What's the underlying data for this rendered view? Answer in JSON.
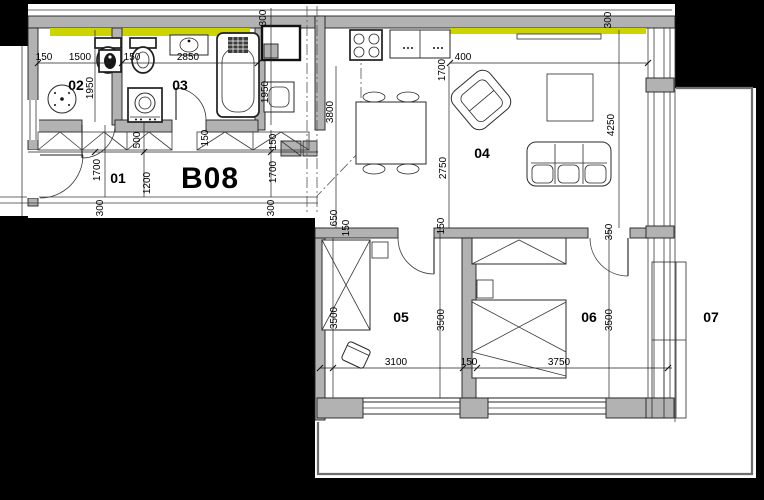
{
  "unit": {
    "code": "B08"
  },
  "rooms": {
    "r01": "01",
    "r02": "02",
    "r03": "03",
    "r04": "04",
    "r05": "05",
    "r06": "06",
    "r07": "07"
  },
  "dims": {
    "d150": "150",
    "d300": "300",
    "d350": "350",
    "d400": "400",
    "d500": "500",
    "d650": "650",
    "d1200": "1200",
    "d1500": "1500",
    "d1700": "1700",
    "d1950": "1950",
    "d2750": "2750",
    "d2850": "2850",
    "d3100": "3100",
    "d3500": "3500",
    "d3750": "3750",
    "d3800": "3800",
    "d4250": "4250"
  },
  "fixtures": [
    "toilet",
    "round-washbasin",
    "washbasin",
    "vanity-sink",
    "bathtub",
    "washing-machine",
    "stove",
    "kitchen-counter",
    "dining-table",
    "chair",
    "armchair",
    "sofa",
    "coffee-table",
    "tv-board",
    "bed",
    "wardrobe",
    "bedside-table",
    "door"
  ],
  "colors": {
    "background": "#000000",
    "floor": "#ffffff",
    "wall": "#b2b2b2",
    "insulation_highlight": "#ccd400",
    "line": "#1c1c1c",
    "terrace_line": "#6e6e6e"
  }
}
